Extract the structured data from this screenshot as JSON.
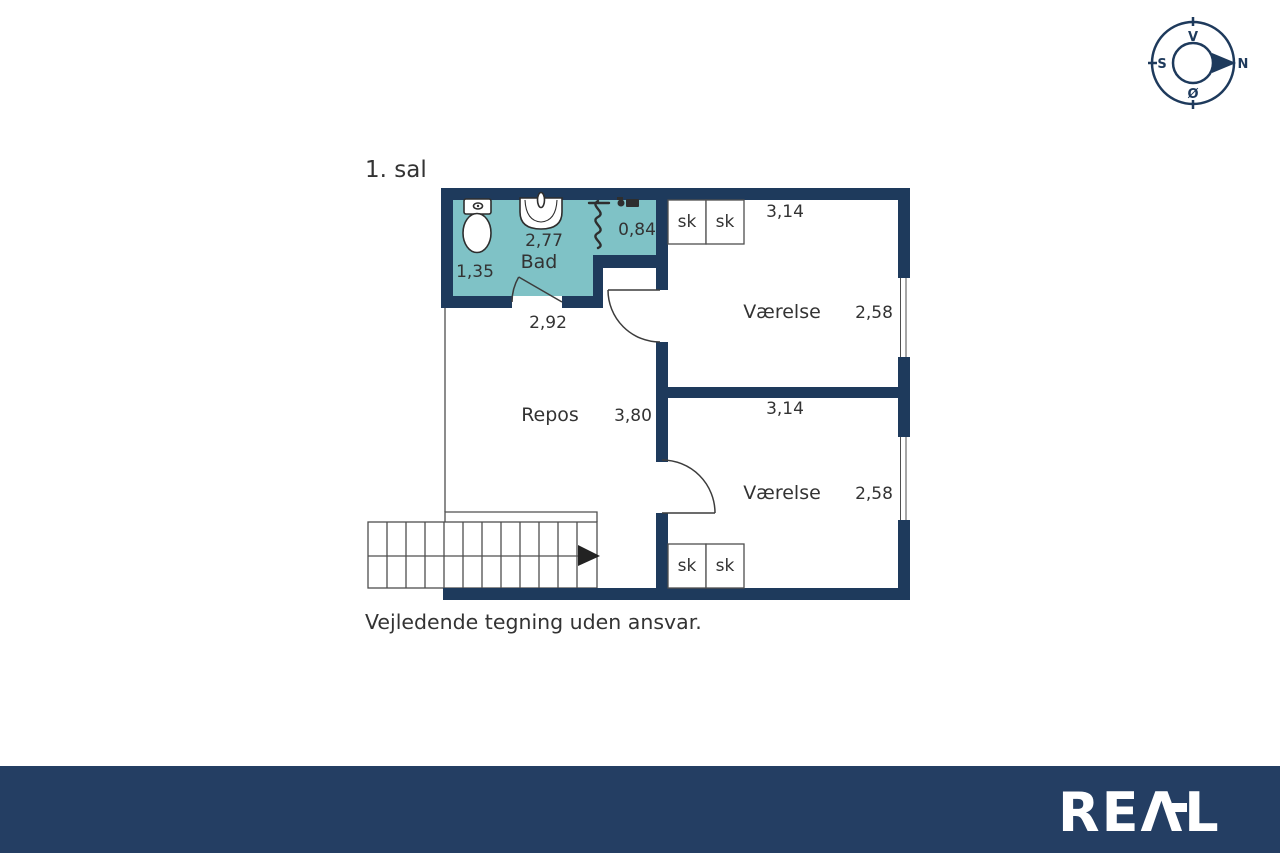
{
  "title": "1. sal",
  "disclaimer": "Vejledende tegning uden ansvar.",
  "compass": {
    "top": "V",
    "right": "N",
    "bottom": "Ø",
    "left": "S"
  },
  "plan": {
    "bath": {
      "name": "Bad",
      "dim_top": "2,77",
      "dim_left": "1,35",
      "shower_dim": "0,84"
    },
    "repos": {
      "name": "Repos",
      "dim_top": "2,92",
      "dim_side": "3,80"
    },
    "room_top": {
      "name": "Værelse",
      "dim_top": "3,14",
      "dim_side": "2,58",
      "closets": [
        "sk",
        "sk"
      ]
    },
    "room_bottom": {
      "name": "Værelse",
      "dim_top": "3,14",
      "dim_side": "2,58",
      "closets": [
        "sk",
        "sk"
      ]
    }
  },
  "footer": {
    "brand": "REAL",
    "brand_display": "REΛL"
  },
  "colors": {
    "wall": "#1e3a5c",
    "bath_fill": "#7fc2c6",
    "footer_bg": "#243e63",
    "text": "#333333",
    "line": "#4f4f4f",
    "fixture_line": "#2e2e2e",
    "logo": "#ffffff"
  }
}
